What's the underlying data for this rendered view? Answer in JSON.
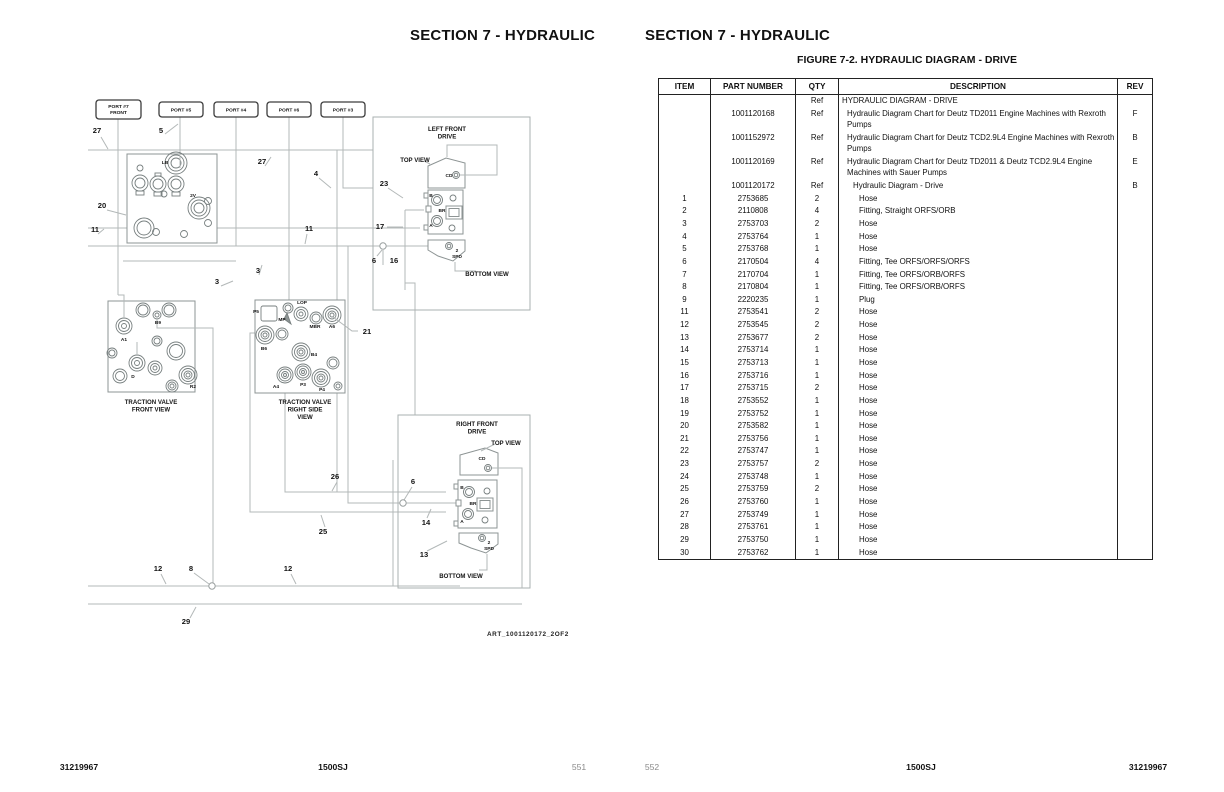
{
  "left_page": {
    "header": "SECTION 7 - HYDRAULIC",
    "footer": {
      "left": "31219967",
      "center": "1500SJ",
      "right": "551"
    },
    "diagram": {
      "art_ref": "ART_1001120172_2OF2",
      "port_boxes": [
        {
          "x": 96,
          "y": 100,
          "w": 45,
          "h": 19,
          "lines": [
            "PORT #7",
            "FRONT"
          ]
        },
        {
          "x": 159,
          "y": 102,
          "w": 44,
          "h": 15,
          "lines": [
            "PORT #5"
          ]
        },
        {
          "x": 214,
          "y": 102,
          "w": 44,
          "h": 15,
          "lines": [
            "PORT #4"
          ]
        },
        {
          "x": 267,
          "y": 102,
          "w": 44,
          "h": 15,
          "lines": [
            "PORT #6"
          ]
        },
        {
          "x": 321,
          "y": 102,
          "w": 44,
          "h": 15,
          "lines": [
            "PORT #3"
          ]
        }
      ],
      "callouts": [
        {
          "x": 97,
          "y": 133,
          "t": "27"
        },
        {
          "x": 161,
          "y": 133,
          "t": "5"
        },
        {
          "x": 262,
          "y": 164,
          "t": "27"
        },
        {
          "x": 316,
          "y": 176,
          "t": "4"
        },
        {
          "x": 384,
          "y": 186,
          "t": "23"
        },
        {
          "x": 102,
          "y": 208,
          "t": "20"
        },
        {
          "x": 95,
          "y": 232,
          "t": "11"
        },
        {
          "x": 309,
          "y": 231,
          "t": "11"
        },
        {
          "x": 380,
          "y": 229,
          "t": "17"
        },
        {
          "x": 374,
          "y": 263,
          "t": "6"
        },
        {
          "x": 394,
          "y": 263,
          "t": "16"
        },
        {
          "x": 217,
          "y": 284,
          "t": "3"
        },
        {
          "x": 258,
          "y": 273,
          "t": "3"
        },
        {
          "x": 367,
          "y": 334,
          "t": "21"
        },
        {
          "x": 335,
          "y": 479,
          "t": "26"
        },
        {
          "x": 413,
          "y": 484,
          "t": "6"
        },
        {
          "x": 426,
          "y": 525,
          "t": "14"
        },
        {
          "x": 323,
          "y": 534,
          "t": "25"
        },
        {
          "x": 424,
          "y": 557,
          "t": "13"
        },
        {
          "x": 158,
          "y": 571,
          "t": "12"
        },
        {
          "x": 191,
          "y": 571,
          "t": "8"
        },
        {
          "x": 288,
          "y": 571,
          "t": "12"
        },
        {
          "x": 186,
          "y": 624,
          "t": "29"
        }
      ],
      "component_labels": [
        {
          "x": 165,
          "y": 164,
          "t": "LB"
        },
        {
          "x": 193,
          "y": 197,
          "t": "2V"
        },
        {
          "x": 124,
          "y": 341,
          "t": "A1"
        },
        {
          "x": 158,
          "y": 324,
          "t": "B9"
        },
        {
          "x": 133,
          "y": 378,
          "t": "D"
        },
        {
          "x": 193,
          "y": 388,
          "t": "R2"
        },
        {
          "x": 256,
          "y": 313,
          "t": "P5"
        },
        {
          "x": 282,
          "y": 321,
          "t": "MP"
        },
        {
          "x": 302,
          "y": 304,
          "t": "LOP"
        },
        {
          "x": 315,
          "y": 328,
          "t": "MBR"
        },
        {
          "x": 332,
          "y": 328,
          "t": "A6"
        },
        {
          "x": 264,
          "y": 350,
          "t": "B6"
        },
        {
          "x": 314,
          "y": 356,
          "t": "B4"
        },
        {
          "x": 276,
          "y": 388,
          "t": "A4"
        },
        {
          "x": 303,
          "y": 386,
          "t": "P3"
        },
        {
          "x": 322,
          "y": 391,
          "t": "P4"
        },
        {
          "x": 449,
          "y": 177,
          "t": "CD"
        },
        {
          "x": 431,
          "y": 197,
          "t": "B"
        },
        {
          "x": 442,
          "y": 212,
          "t": "BR"
        },
        {
          "x": 431,
          "y": 227,
          "t": "A"
        },
        {
          "x": 457,
          "y": 252,
          "t": "2"
        },
        {
          "x": 457,
          "y": 258,
          "t": "SPD"
        },
        {
          "x": 482,
          "y": 460,
          "t": "CD"
        },
        {
          "x": 462,
          "y": 489,
          "t": "B"
        },
        {
          "x": 473,
          "y": 505,
          "t": "BR"
        },
        {
          "x": 462,
          "y": 523,
          "t": "A"
        },
        {
          "x": 489,
          "y": 544,
          "t": "2"
        },
        {
          "x": 489,
          "y": 550,
          "t": "SPD"
        }
      ],
      "view_labels": [
        {
          "x": 151,
          "y": 404,
          "lines": [
            "TRACTION VALVE",
            "FRONT VIEW"
          ]
        },
        {
          "x": 305,
          "y": 404,
          "lines": [
            "TRACTION VALVE",
            "RIGHT SIDE",
            "VIEW"
          ]
        },
        {
          "x": 447,
          "y": 131,
          "lines": [
            "LEFT FRONT",
            "DRIVE"
          ]
        },
        {
          "x": 415,
          "y": 162,
          "lines": [
            "TOP VIEW"
          ]
        },
        {
          "x": 487,
          "y": 276,
          "lines": [
            "BOTTOM VIEW"
          ]
        },
        {
          "x": 477,
          "y": 426,
          "lines": [
            "RIGHT FRONT",
            "DRIVE"
          ]
        },
        {
          "x": 506,
          "y": 445,
          "lines": [
            "TOP VIEW"
          ]
        },
        {
          "x": 461,
          "y": 578,
          "lines": [
            "BOTTOM VIEW"
          ]
        }
      ]
    }
  },
  "right_page": {
    "header": "SECTION 7 - HYDRAULIC",
    "figure_title": "FIGURE 7-2. HYDRAULIC DIAGRAM - DRIVE",
    "footer": {
      "left": "552",
      "center": "1500SJ",
      "right": "31219967"
    },
    "table": {
      "headers": [
        "ITEM",
        "PART NUMBER",
        "QTY",
        "DESCRIPTION",
        "REV"
      ],
      "rows": [
        {
          "it": "",
          "pn": "",
          "qty": "Ref",
          "desc": "HYDRAULIC DIAGRAM - DRIVE",
          "rev": "",
          "ind": 0
        },
        {
          "it": "",
          "pn": "1001120168",
          "qty": "Ref",
          "desc": "Hydraulic Diagram Chart for Deutz TD2011 Engine Machines with Rexroth Pumps",
          "rev": "F",
          "ind": 1
        },
        {
          "it": "",
          "pn": "1001152972",
          "qty": "Ref",
          "desc": "Hydraulic Diagram Chart for Deutz TCD2.9L4 Engine Machines with Rexroth Pumps",
          "rev": "B",
          "ind": 1
        },
        {
          "it": "",
          "pn": "1001120169",
          "qty": "Ref",
          "desc": "Hydraulic Diagram Chart for Deutz TD2011 & Deutz TCD2.9L4 Engine Machines with Sauer Pumps",
          "rev": "E",
          "ind": 1
        },
        {
          "it": "",
          "pn": "1001120172",
          "qty": "Ref",
          "desc": "Hydraulic Diagram - Drive",
          "rev": "B",
          "ind": 2
        },
        {
          "it": "1",
          "pn": "2753685",
          "qty": "2",
          "desc": "Hose",
          "rev": "",
          "ind": 3
        },
        {
          "it": "2",
          "pn": "2110808",
          "qty": "4",
          "desc": "Fitting, Straight ORFS/ORB",
          "rev": "",
          "ind": 3
        },
        {
          "it": "3",
          "pn": "2753703",
          "qty": "2",
          "desc": "Hose",
          "rev": "",
          "ind": 3
        },
        {
          "it": "4",
          "pn": "2753764",
          "qty": "1",
          "desc": "Hose",
          "rev": "",
          "ind": 3
        },
        {
          "it": "5",
          "pn": "2753768",
          "qty": "1",
          "desc": "Hose",
          "rev": "",
          "ind": 3
        },
        {
          "it": "6",
          "pn": "2170504",
          "qty": "4",
          "desc": "Fitting, Tee ORFS/ORFS/ORFS",
          "rev": "",
          "ind": 3
        },
        {
          "it": "7",
          "pn": "2170704",
          "qty": "1",
          "desc": "Fitting, Tee ORFS/ORB/ORFS",
          "rev": "",
          "ind": 3
        },
        {
          "it": "8",
          "pn": "2170804",
          "qty": "1",
          "desc": "Fitting, Tee ORFS/ORB/ORFS",
          "rev": "",
          "ind": 3
        },
        {
          "it": "9",
          "pn": "2220235",
          "qty": "1",
          "desc": "Plug",
          "rev": "",
          "ind": 3
        },
        {
          "it": "11",
          "pn": "2753541",
          "qty": "2",
          "desc": "Hose",
          "rev": "",
          "ind": 3
        },
        {
          "it": "12",
          "pn": "2753545",
          "qty": "2",
          "desc": "Hose",
          "rev": "",
          "ind": 3
        },
        {
          "it": "13",
          "pn": "2753677",
          "qty": "2",
          "desc": "Hose",
          "rev": "",
          "ind": 3
        },
        {
          "it": "14",
          "pn": "2753714",
          "qty": "1",
          "desc": "Hose",
          "rev": "",
          "ind": 3
        },
        {
          "it": "15",
          "pn": "2753713",
          "qty": "1",
          "desc": "Hose",
          "rev": "",
          "ind": 3
        },
        {
          "it": "16",
          "pn": "2753716",
          "qty": "1",
          "desc": "Hose",
          "rev": "",
          "ind": 3
        },
        {
          "it": "17",
          "pn": "2753715",
          "qty": "2",
          "desc": "Hose",
          "rev": "",
          "ind": 3
        },
        {
          "it": "18",
          "pn": "2753552",
          "qty": "1",
          "desc": "Hose",
          "rev": "",
          "ind": 3
        },
        {
          "it": "19",
          "pn": "2753752",
          "qty": "1",
          "desc": "Hose",
          "rev": "",
          "ind": 3
        },
        {
          "it": "20",
          "pn": "2753582",
          "qty": "1",
          "desc": "Hose",
          "rev": "",
          "ind": 3
        },
        {
          "it": "21",
          "pn": "2753756",
          "qty": "1",
          "desc": "Hose",
          "rev": "",
          "ind": 3
        },
        {
          "it": "22",
          "pn": "2753747",
          "qty": "1",
          "desc": "Hose",
          "rev": "",
          "ind": 3
        },
        {
          "it": "23",
          "pn": "2753757",
          "qty": "2",
          "desc": "Hose",
          "rev": "",
          "ind": 3
        },
        {
          "it": "24",
          "pn": "2753748",
          "qty": "1",
          "desc": "Hose",
          "rev": "",
          "ind": 3
        },
        {
          "it": "25",
          "pn": "2753759",
          "qty": "2",
          "desc": "Hose",
          "rev": "",
          "ind": 3
        },
        {
          "it": "26",
          "pn": "2753760",
          "qty": "1",
          "desc": "Hose",
          "rev": "",
          "ind": 3
        },
        {
          "it": "27",
          "pn": "2753749",
          "qty": "1",
          "desc": "Hose",
          "rev": "",
          "ind": 3
        },
        {
          "it": "28",
          "pn": "2753761",
          "qty": "1",
          "desc": "Hose",
          "rev": "",
          "ind": 3
        },
        {
          "it": "29",
          "pn": "2753750",
          "qty": "1",
          "desc": "Hose",
          "rev": "",
          "ind": 3
        },
        {
          "it": "30",
          "pn": "2753762",
          "qty": "1",
          "desc": "Hose",
          "rev": "",
          "ind": 3
        }
      ]
    }
  }
}
